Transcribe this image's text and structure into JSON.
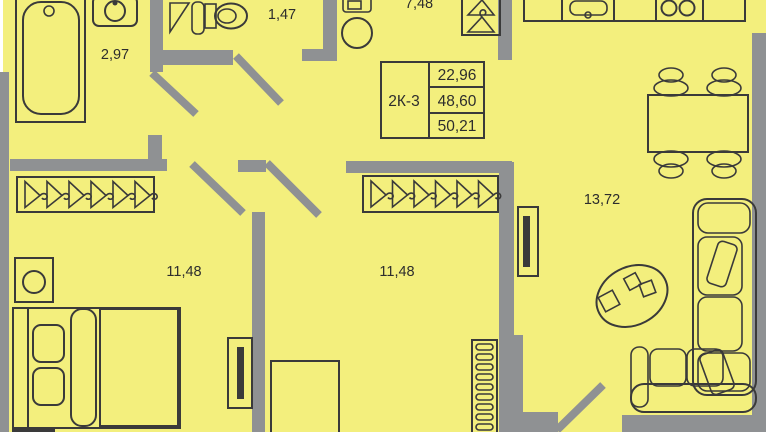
{
  "legend": {
    "type_label": "2К-3",
    "living_area": "22,96",
    "total_area": "48,60",
    "total_area_with_balcony": "50,21"
  },
  "rooms": [
    {
      "id": "bathroom",
      "area": "2,97",
      "features": [
        "bathtub-icon",
        "washbasin-icon"
      ]
    },
    {
      "id": "wc",
      "area": "1,47",
      "features": [
        "corner-tray-icon",
        "cabinet-icon",
        "toilet-icon"
      ]
    },
    {
      "id": "hallway",
      "area": "7,48",
      "features": [
        "shelf-icon",
        "washing-machine-icon",
        "wardrobe-hangers-icon"
      ]
    },
    {
      "id": "bedroom-1",
      "area": "11,48",
      "features": [
        "wardrobe-hangers-icon",
        "nightstand-icon",
        "double-bed-icon",
        "tv-icon"
      ]
    },
    {
      "id": "bedroom-2",
      "area": "11,48",
      "features": [
        "wardrobe-hangers-icon",
        "desk-icon",
        "radiator-icon"
      ]
    },
    {
      "id": "kitchen-living",
      "area": "13,72",
      "features": [
        "kitchen-counter-icon",
        "kitchen-sink-icon",
        "stove-icon",
        "dining-table-icon",
        "chair-icon",
        "tv-icon",
        "coffee-table-icon",
        "corner-sofa-icon"
      ]
    }
  ],
  "colors": {
    "floor": "#f3ef7d",
    "wall": "#8f9193",
    "line": "#3a3a3a",
    "text": "#2d2d2d"
  }
}
